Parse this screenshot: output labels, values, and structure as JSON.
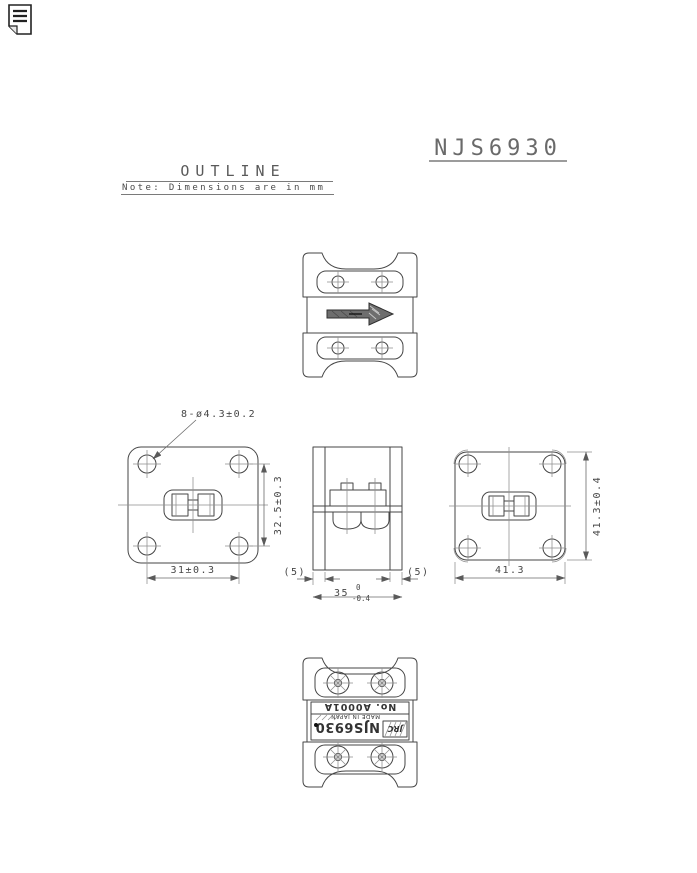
{
  "title": "NJS6930",
  "header": {
    "outline": "OUTLINE",
    "note": "Note: Dimensions are in mm"
  },
  "dims": {
    "holes": "8-ø4.3±0.2",
    "front_vertical": "32.5±0.3",
    "front_horizontal": "31±0.3",
    "flange_left": "(5)",
    "flange_right": "(5)",
    "body_length": "35",
    "body_length_tol_upper": "0",
    "body_length_tol_lower": "-0.4",
    "rear_width": "41.3",
    "rear_height": "41.3±0.4"
  },
  "label": {
    "brand": "JRC",
    "model": "NJS6930",
    "origin": "MADE IN JAPAN",
    "serial": "No. A0001A"
  },
  "colors": {
    "line": "#464646",
    "dimension": "#6a6a6a",
    "centerline": "#8f8f8f",
    "arrow_fill": "#6e6e6e",
    "title": "#6a6a6a",
    "underline": "#9c9c9c"
  }
}
